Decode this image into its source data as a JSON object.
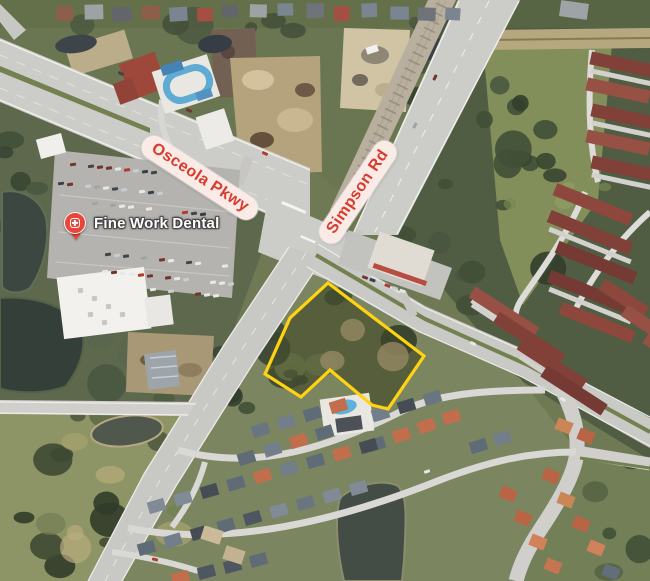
{
  "map": {
    "view": "satellite",
    "road_labels": [
      {
        "id": "osceola-pkwy",
        "name": "Osceola Pkwy"
      },
      {
        "id": "simpson-rd",
        "name": "Simpson Rd"
      }
    ],
    "poi_labels": [
      {
        "id": "fine-work-dental",
        "name": "Fine Work Dental",
        "icon": "medical-pin-icon"
      }
    ],
    "parcel_highlight": {
      "outline_color": "#FFD20A"
    },
    "label_style": {
      "road_label_text_color": "#D93B2D",
      "road_label_bg_color": "#FBEBE7",
      "poi_label_text_color": "#FFFFFF",
      "poi_pin_color": "#E8463A"
    }
  }
}
